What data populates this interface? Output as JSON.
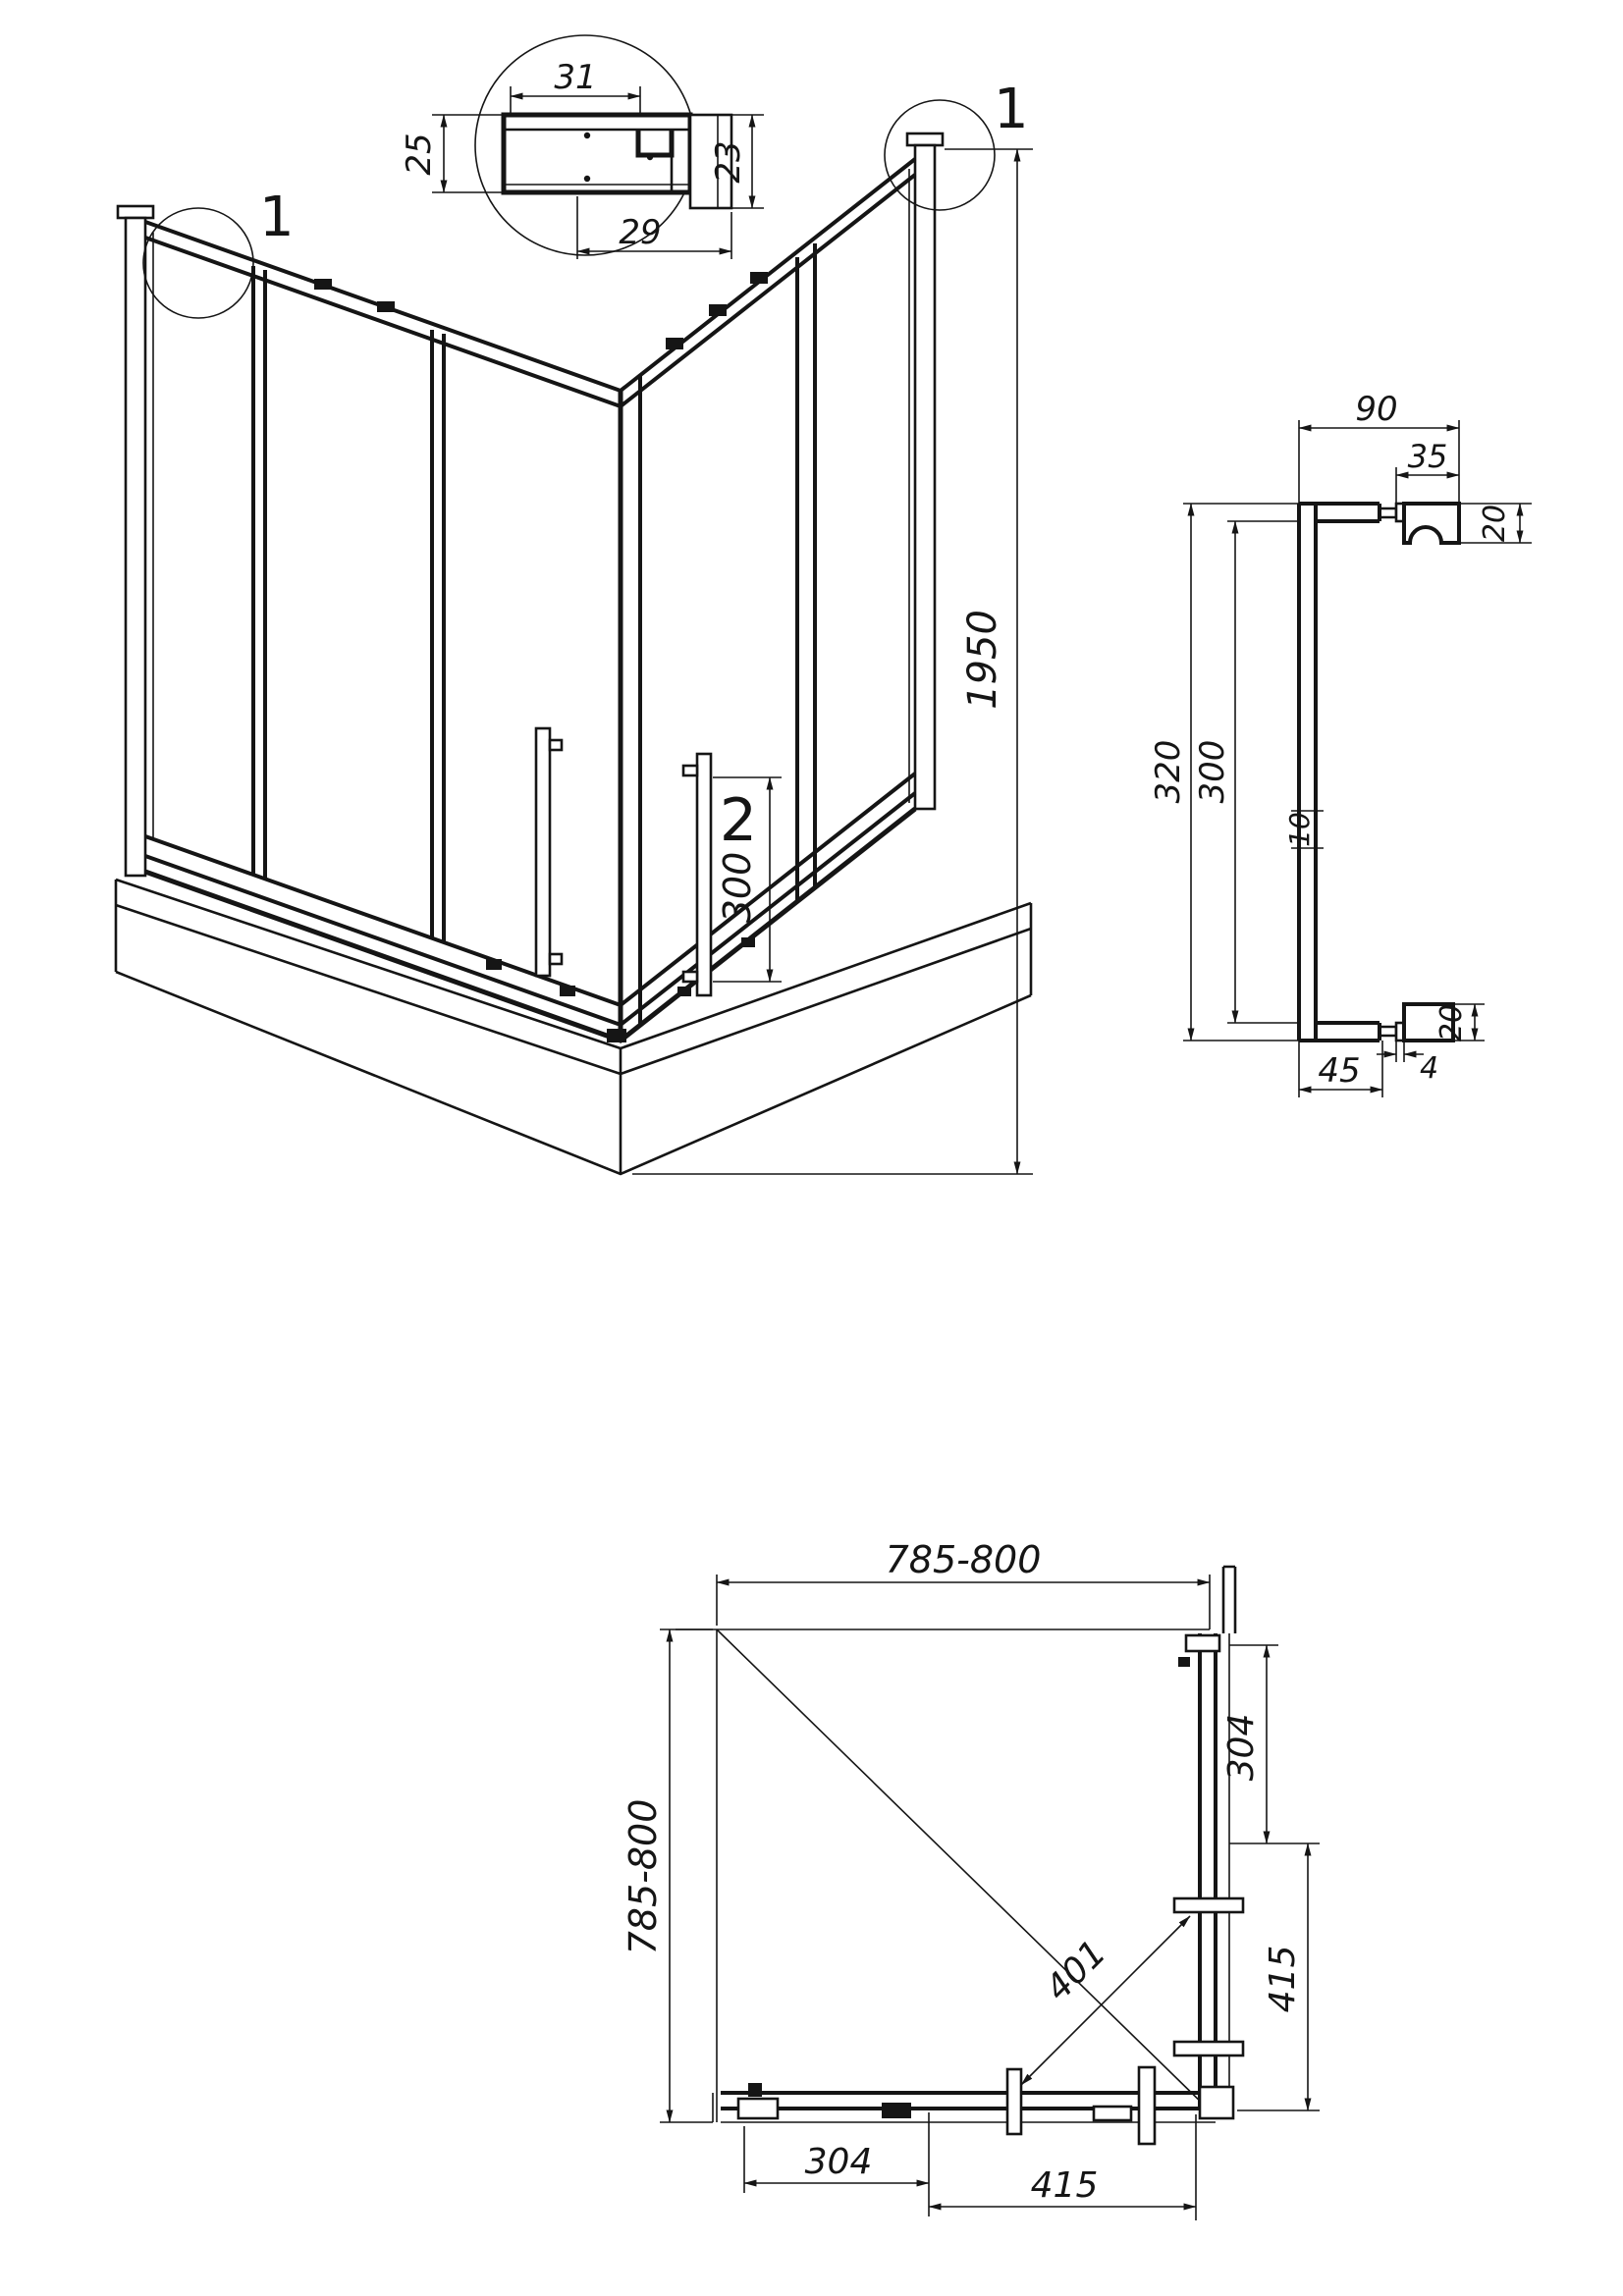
{
  "page": {
    "background": "#ffffff",
    "line_color": "#151515"
  },
  "detail_callout": {
    "left_balloon": "1",
    "right_balloon": "1"
  },
  "profile_detail": {
    "dim_top": "31",
    "dim_left": "25",
    "dim_right": "23",
    "dim_bottom": "29"
  },
  "perspective": {
    "dim_height": "1950",
    "handle_balloon": "2",
    "dim_handle_holes": "300"
  },
  "handle": {
    "dim_overall_width": "90",
    "dim_pad_width": "35",
    "dim_pad_height_top": "20",
    "dim_length_overall": "320",
    "dim_length_holes": "300",
    "dim_bar_thickness": "10",
    "dim_arm": "45",
    "dim_washer": "4",
    "dim_pad_height_bottom": "20"
  },
  "plan": {
    "dim_width": "785-800",
    "dim_depth": "785-800",
    "dim_side_right_upper": "304",
    "dim_side_right_lower": "415",
    "dim_diagonal_opening": "401",
    "dim_side_bottom_left": "304",
    "dim_side_bottom_right": "415"
  }
}
